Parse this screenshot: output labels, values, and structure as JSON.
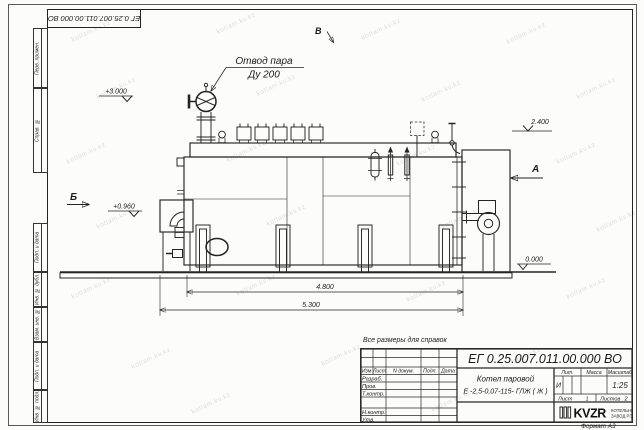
{
  "watermark": {
    "text": "kotlam.kv.kz"
  },
  "frame": {
    "top_stamp": "ЕГ 0.25.007.011.00.000  ВО",
    "side_cells": {
      "c1": "Перв. примен.",
      "c2": "Справ. №",
      "c3": "Подп. и дата",
      "c4": "Инв. № дубл.",
      "c5": "Взам. инв. №",
      "c6": "Подп. и дата",
      "c7": "Инв. № подл."
    },
    "format_label": "Формат А3"
  },
  "drawing": {
    "note": "Все размеры для справок",
    "callout_line1": "Отвод пара",
    "callout_line2": "Ду 200",
    "views": {
      "b": "Б",
      "a": "А",
      "v": "В"
    },
    "elevations": {
      "top": "+3.000",
      "mid": "2.400",
      "burner": "+0.960",
      "ground": "0.000"
    },
    "dims": {
      "inner": "4.800",
      "outer": "5.300"
    }
  },
  "title_block": {
    "doc_number": "ЕГ 0.25.007.011.00.000  ВО",
    "name_line1": "Котел паровой",
    "name_line2": "Е -2,5-0,07-115- ГЛЖ ( Ж )",
    "cols": {
      "izm": "Изм",
      "list": "Лист",
      "docum": "N докум.",
      "podp": "Подп.",
      "data": "Дата"
    },
    "rows": {
      "r1": "Разраб.",
      "r2": "Пров.",
      "r3": "Т.контр.",
      "r4": "",
      "r5": "Н.контр.",
      "r6": "Утв."
    },
    "lit_header": "Лит.",
    "mass_header": "Масса",
    "scale_header": "Масштаб",
    "lit_value": "И",
    "scale_value": "1:25",
    "sheet_label": "Лист",
    "sheet_value": "1",
    "sheets_label": "Листов",
    "sheets_value": "2",
    "logo_text": "KVZR",
    "logo_sub1": "КОТЕЛЬНЫЙ",
    "logo_sub2": "ЗАВОД РЭП"
  }
}
